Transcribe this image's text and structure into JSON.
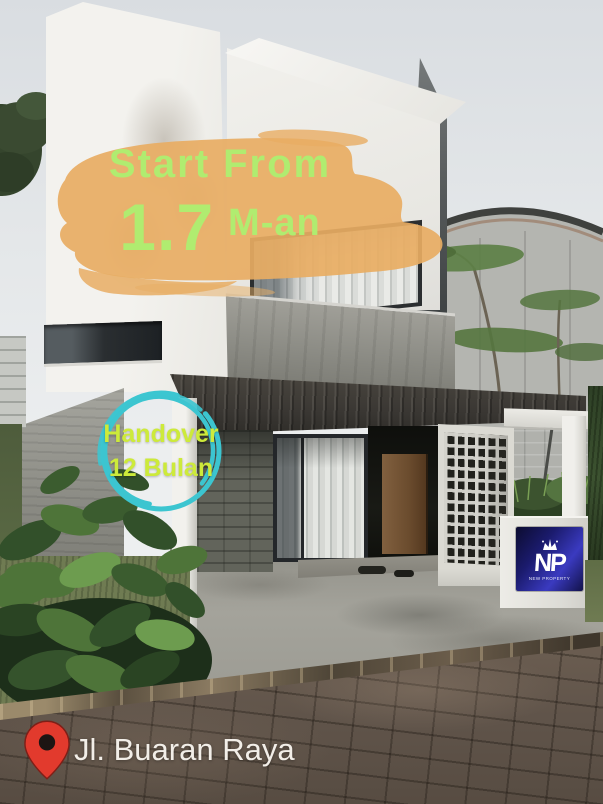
{
  "photo": {
    "price_overlay": {
      "line1": "Start From",
      "value": "1.7",
      "unit": "M-an"
    },
    "handover_badge": {
      "line1": "Handover",
      "line2": "12 Bulan"
    },
    "address_bar": {
      "label": "Jl. Buaran Raya"
    },
    "logo": {
      "initials": "NP",
      "tagline": "NEW PROPERTY"
    }
  },
  "colors": {
    "brush_orange": "#e8ad63",
    "price_green": "#b0ec70",
    "badge_green": "#cdea3a",
    "ring_teal": "#3cc5d0",
    "address_white": "#f2eee8",
    "pin_red": "#e23a2d"
  }
}
